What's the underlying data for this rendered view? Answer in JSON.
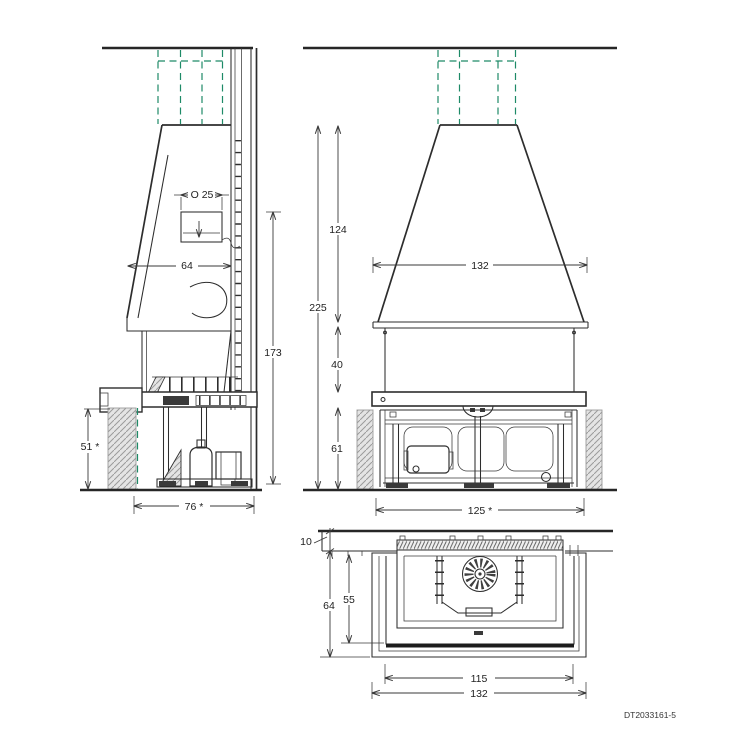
{
  "drawing": {
    "number": "DT2033161-5",
    "colors": {
      "line": "#2d2d2d",
      "dimension": "#3a3a3a",
      "flue_green": "#1e8a67",
      "hatch_fill": "#e4e4e4",
      "hatch_line": "#9b9b9b"
    },
    "side_view": {
      "dims": {
        "flue_diameter": "O 25",
        "hood_depth": "64",
        "height_to_collar": "173",
        "wall_height": "51 *",
        "base_depth": "76 *"
      }
    },
    "front_view": {
      "dims": {
        "hood_height": "124",
        "total_height": "225",
        "hood_width": "132",
        "band_height": "40",
        "base_height": "61",
        "base_width": "125 *"
      }
    },
    "top_view": {
      "dims": {
        "wall_offset": "10",
        "depth_outer": "64",
        "depth_inner": "55",
        "width_inner": "115",
        "width_outer": "132"
      }
    }
  }
}
